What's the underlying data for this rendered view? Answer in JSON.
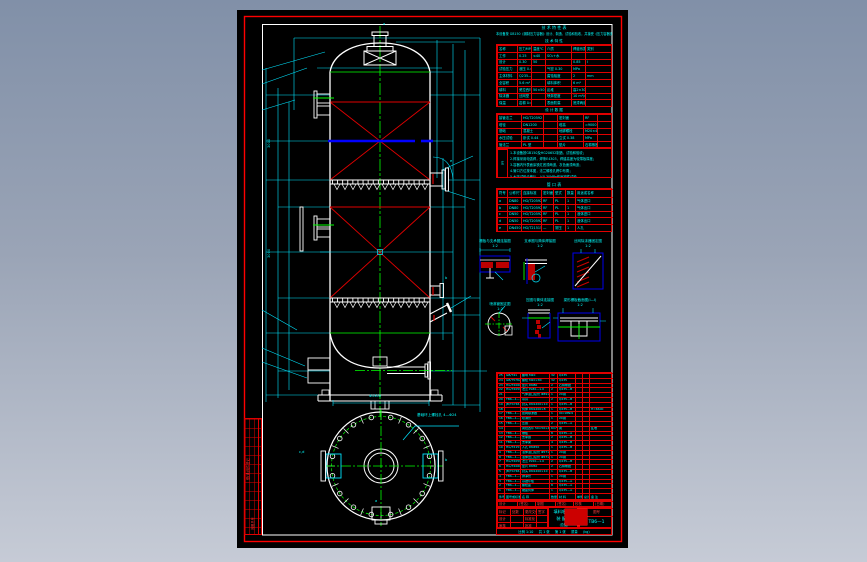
{
  "app": {
    "title": "填料吸收塔装配图 — CAD 预览"
  },
  "colors": {
    "background_top": "#8190a8",
    "background_bottom": "#c6cbd6",
    "canvas": "#000000",
    "frame_red": "#ff0000",
    "line_white": "#ffffff",
    "annotation_cyan": "#00ffff",
    "centerline_green": "#00ff00",
    "highlight_blue": "#0000ff"
  },
  "design_table": {
    "title": "技  术  特  性  表",
    "note_line": "本设备按 GB150《钢制压力容器》设计、制造、试验和验收，并接受《压力容器安全技术监察规程》监督。",
    "subtitle": "技  术  特  性",
    "rows": [
      [
        "名称",
        "压力MPa",
        "温度℃",
        "介质",
        "焊缝系数",
        "类别"
      ],
      [
        "工作",
        "0.25",
        "≤40",
        "SO₂+水",
        "",
        ""
      ],
      [
        "设计",
        "0.30",
        "50",
        "",
        "0.85",
        "Ⅰ"
      ],
      [
        "试验压力",
        "液压 0.44",
        "",
        "气密 0.30",
        "MPa",
        ""
      ],
      [
        "主体材料",
        "Q235—B",
        "",
        "腐蚀裕度",
        "2",
        "mm"
      ],
      [
        "全容积",
        "5.6 m³",
        "",
        "填料体积",
        "6 m³",
        ""
      ],
      [
        "填料",
        "瓷拉西环",
        "50×50×4.5",
        "乱堆",
        "高2×3000",
        ""
      ],
      [
        "除沫器",
        "丝网型",
        "",
        "喷淋密度",
        "10 m³/m²h",
        ""
      ],
      [
        "保温",
        "岩棉 δ=50",
        "",
        "表面防腐",
        "底漆两道",
        ""
      ]
    ],
    "section2_title": "设  计  数  据",
    "rows2": [
      [
        "接管法兰",
        "HG/T20592",
        "",
        "密封面",
        "RF",
        ""
      ],
      [
        "塔径",
        "DN1200",
        "",
        "塔高",
        "≈9000",
        ""
      ],
      [
        "基础",
        "混凝土",
        "",
        "地脚螺栓",
        "M20×4",
        ""
      ],
      [
        "水压试验",
        "卧试 0.44",
        "",
        "立试 0.38",
        "MPa",
        ""
      ],
      [
        "管法兰",
        "PL 型",
        "",
        "垫片",
        "石棉橡胶",
        ""
      ]
    ],
    "notes_label": "注",
    "notes": [
      "1.本设备按GB150及HG20652制造、试验和验收；",
      "2.焊接采用电弧焊，焊条E4303，焊缝高度为较薄板厚度；",
      "3.容器内外表面涂铁红底漆两道，灰色面漆两道；",
      "4.管口方位按本图，法兰螺栓孔跨中布置；",
      "5.水压试验合格后，以0.30MPa作气密性试验。"
    ]
  },
  "nozzle_table": {
    "title": "管  口  表",
    "rows": [
      [
        "符号",
        "公称尺寸",
        "连接标准",
        "密封面",
        "型式",
        "数量",
        "用途或名称"
      ],
      [
        "a",
        "DN80",
        "HG/T20592",
        "RF",
        "PL",
        "1",
        "气体进口"
      ],
      [
        "b",
        "DN80",
        "HG/T20592",
        "RF",
        "PL",
        "1",
        "气体出口"
      ],
      [
        "c",
        "DN50",
        "HG/T20592",
        "RF",
        "PL",
        "1",
        "液体进口"
      ],
      [
        "d",
        "DN50",
        "HG/T20592",
        "RF",
        "PL",
        "1",
        "液体出口"
      ],
      [
        "e",
        "DN450",
        "HG/T21515",
        "—",
        "常压",
        "1",
        "人孔"
      ]
    ]
  },
  "details": [
    {
      "title": "栅板与支承圈连接图",
      "scale": "1:2"
    },
    {
      "title": "支承圈与筒体焊接图",
      "scale": "1:2"
    },
    {
      "title": "丝网除沫器固定图",
      "scale": "1:2"
    },
    {
      "title": "喷淋管固定图",
      "scale": "1:2"
    },
    {
      "title": "压圈与筒体连接图",
      "scale": "1:2"
    },
    {
      "title": "梁形栅板截面图(Ⅰ—Ⅰ)",
      "scale": "1:2"
    }
  ],
  "bom": {
    "rows": [
      [
        "25",
        "GB/T41",
        "螺母 M20",
        "32",
        "Q235",
        "",
        "",
        ""
      ],
      [
        "24",
        "GB/T5782",
        "螺栓 M20×80",
        "32",
        "Q235",
        "",
        "",
        ""
      ],
      [
        "23",
        "HG/T20606",
        "垫片 DN80",
        "2",
        "石棉橡胶",
        "",
        "",
        ""
      ],
      [
        "22",
        "HG/T20592",
        "法兰 PL80—1.0",
        "2",
        "Q235—B",
        "",
        "",
        ""
      ],
      [
        "21",
        "",
        "气体进口接管 Φ89×4",
        "1",
        "20钢",
        "",
        "",
        ""
      ],
      [
        "20",
        "TB6—1—14",
        "吊耳",
        "2",
        "Q235—B",
        "",
        "",
        ""
      ],
      [
        "19",
        "JB/T4746",
        "封头 DN1200×10",
        "1",
        "Q235—B",
        "",
        "",
        ""
      ],
      [
        "18",
        "",
        "筒体 DN1200×8",
        "1",
        "Q235—B",
        "",
        "",
        "H=6600"
      ],
      [
        "17",
        "TB6—1—13",
        "丝网除沫器",
        "1",
        "0Cr18Ni9",
        "",
        "",
        ""
      ],
      [
        "16",
        "TB6—1—12",
        "喷淋管",
        "1",
        "20钢",
        "",
        "",
        ""
      ],
      [
        "15",
        "TB6—1—11",
        "压圈",
        "2",
        "Q235—A",
        "",
        "",
        ""
      ],
      [
        "14",
        "",
        "瓷拉西环 50×50×4.5",
        "6m³",
        "瓷",
        "",
        "",
        "乱堆"
      ],
      [
        "13",
        "TB6—1—10",
        "栅板",
        "8",
        "Q235—A",
        "",
        "",
        ""
      ],
      [
        "12",
        "TB6—1—09",
        "支承圈",
        "2",
        "Q235—B",
        "",
        "",
        ""
      ],
      [
        "11",
        "TB6—1—08",
        "支承梁",
        "4",
        "Q235—B",
        "",
        "",
        ""
      ],
      [
        "10",
        "HG/T21515",
        "人孔 DN450",
        "1",
        "Q235—B",
        "",
        "",
        ""
      ],
      [
        "9",
        "TB6—1—07",
        "液体进口接管 Φ57×3.5",
        "1",
        "20钢",
        "",
        "",
        ""
      ],
      [
        "8",
        "TB6—1—06",
        "液体出口接管 Φ57×3.5",
        "1",
        "20钢",
        "",
        "",
        ""
      ],
      [
        "7",
        "HG/T20592",
        "法兰 PL50—1.0",
        "2",
        "Q235—B",
        "",
        "",
        ""
      ],
      [
        "6",
        "HG/T20606",
        "垫片 DN50",
        "2",
        "石棉橡胶",
        "",
        "",
        ""
      ],
      [
        "5",
        "JB/T4746",
        "封头 DN1200×10",
        "1",
        "Q235—B",
        "",
        "",
        ""
      ],
      [
        "4",
        "TB6—1—05",
        "排净管",
        "1",
        "20钢",
        "",
        "",
        ""
      ],
      [
        "3",
        "TB6—1—04",
        "基础环板",
        "1",
        "Q235—A",
        "",
        "",
        ""
      ],
      [
        "2",
        "TB6—1—03",
        "螺栓座",
        "8",
        "Q235—A",
        "",
        "",
        ""
      ],
      [
        "1",
        "TB6—1—02",
        "裙座筒体",
        "1",
        "Q235—A",
        "",
        "",
        ""
      ],
      [
        "件号",
        "图号或标准号",
        "名  称",
        "数量",
        "材 料",
        "单件",
        "总计",
        "备 注"
      ]
    ]
  },
  "title_block": {
    "sig_row": [
      "设计",
      "(签名)",
      "制图",
      "(签名)",
      "校核",
      "(日期)"
    ],
    "left_rows": [
      [
        "标记",
        "处数",
        "更改文件号",
        "签字"
      ],
      [
        "设计",
        "",
        "标准化",
        ""
      ],
      [
        "审核",
        "",
        "批准",
        ""
      ]
    ],
    "title_lines": [
      "填料吸收塔",
      "装  配  图",
      "(总图)"
    ],
    "drawing_no_label": "图号",
    "drawing_no": "TB6—1",
    "bottom_line": "比例 1:10 　 共 1 张 　 第 1 张 　 质量 　 (kg)"
  },
  "left_strip": {
    "label": "借(通)用件登记",
    "label2": "底图总号"
  },
  "labels": {
    "nozzle_top": "a",
    "nozzle_manhole": "e",
    "nozzle_right_mid": "b",
    "dim_left_upper": "3000",
    "dim_left_lower": "3000",
    "plan_left": "c,d",
    "plan_right": "b",
    "plan_bottom": "a",
    "plan_leader": "基础环上螺栓孔 4—Φ24",
    "plan_dim": "Φ1300"
  }
}
